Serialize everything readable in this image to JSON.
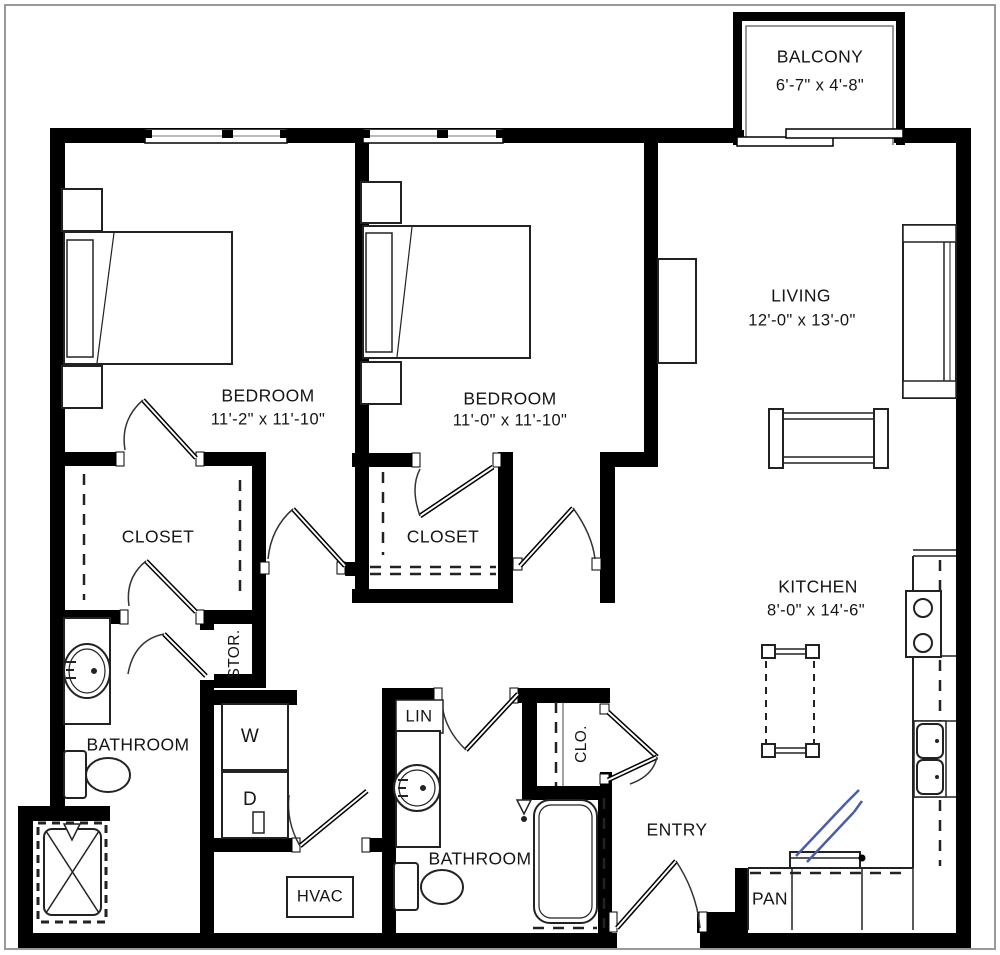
{
  "floor_plan": {
    "unit_rooms": [
      {
        "name": "BALCONY",
        "dims": "6'-7\" x 4'-8\""
      },
      {
        "name": "BEDROOM",
        "dims": "11'-2\" x 11'-10\""
      },
      {
        "name": "BEDROOM",
        "dims": "11'-0\" x 11'-10\""
      },
      {
        "name": "LIVING",
        "dims": "12'-0\" x 13'-0\""
      },
      {
        "name": "KITCHEN",
        "dims": "8'-0\" x 14'-6\""
      }
    ],
    "areas": {
      "closet_1": "CLOSET",
      "closet_2": "CLOSET",
      "storage": "STOR.",
      "bathroom_1": "BATHROOM",
      "bathroom_2": "BATHROOM",
      "linen": "LIN",
      "entry_closet": "CLO.",
      "entry": "ENTRY",
      "pantry": "PAN",
      "washer": "W",
      "dryer": "D",
      "hvac": "HVAC"
    },
    "colors": {
      "wall": "#000000",
      "fixture": "#222222",
      "accent_appliance": "#4a5ea8",
      "frame": "#999999",
      "background": "#ffffff"
    }
  }
}
